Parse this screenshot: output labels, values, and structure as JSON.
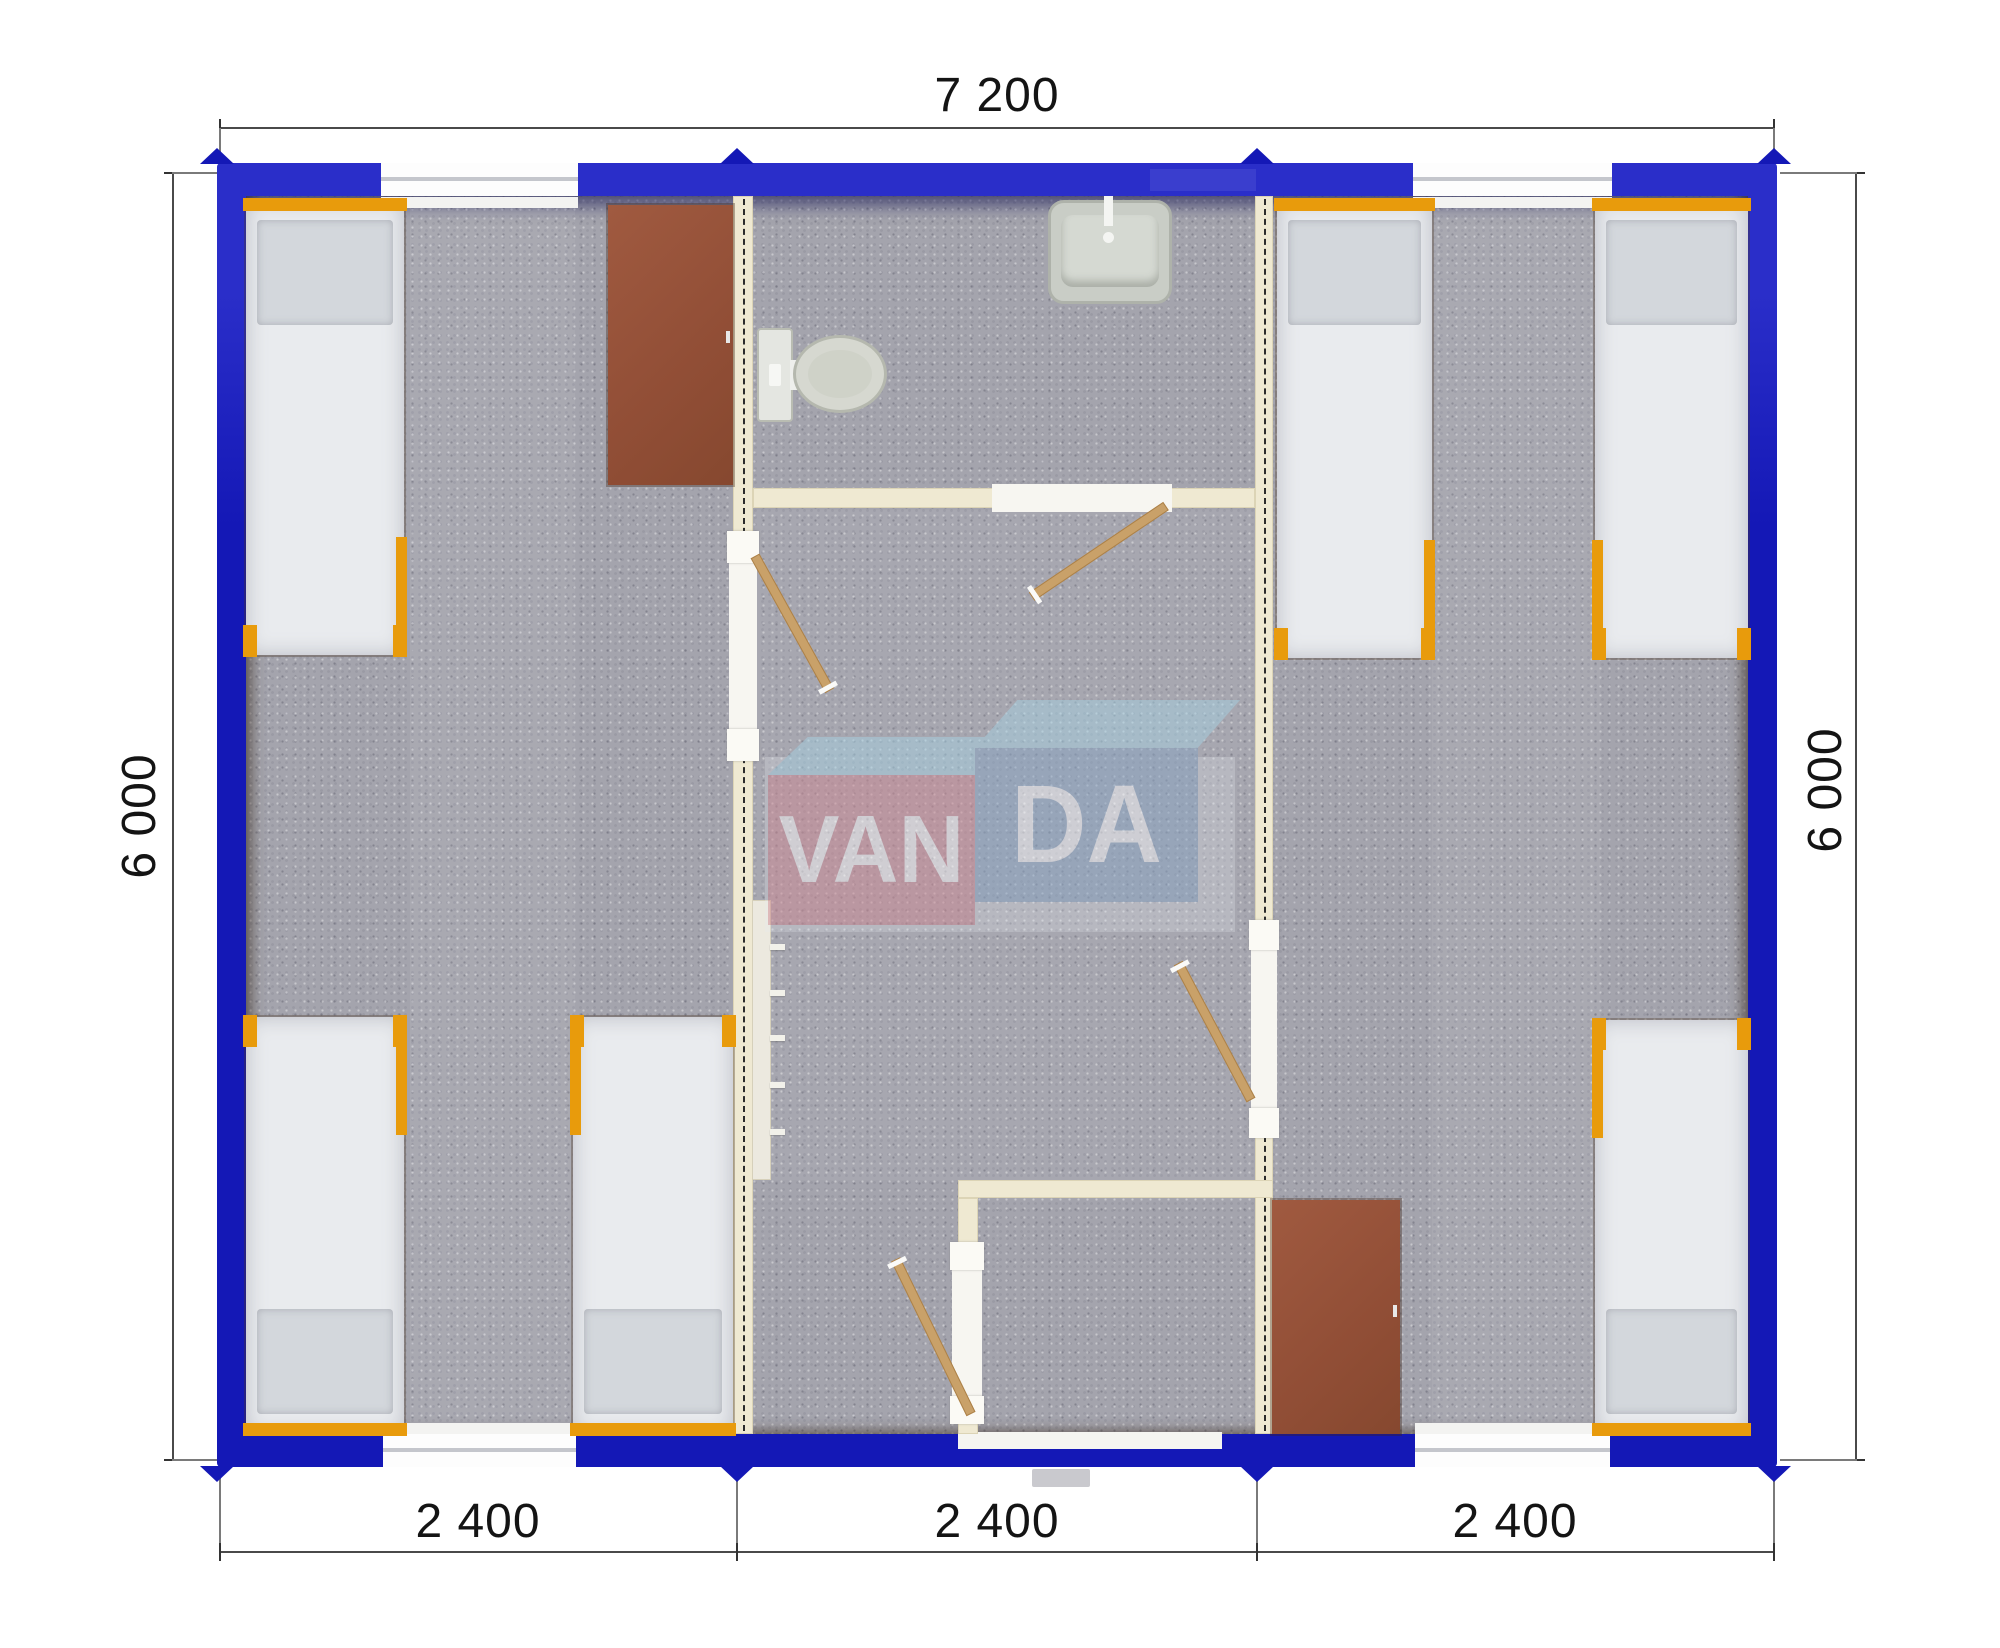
{
  "drawing": {
    "kind": "modular-building-floor-plan",
    "dimensions": {
      "width_total": "7 200",
      "height_left": "6 000",
      "height_right": "6 000",
      "bottom_segments": [
        "2 400",
        "2 400",
        "2 400"
      ]
    },
    "watermark": {
      "part1": "VAN",
      "part2": "DA"
    },
    "colors": {
      "wall_blue": "#1418b6",
      "floor_carpet_gray": "#a4a4ad",
      "partition_cream": "#efe9d2",
      "bed_frame_orange": "#e89b0c",
      "mattress_white": "#e9ebee",
      "wardrobe_brown": "#914e36",
      "door_leaf_wood": "#c9a169",
      "logo_pink": "#cf8691",
      "logo_blue": "#87a4c4",
      "logo_sky": "#a5d2e4",
      "dimension_line": "#4a4a4a"
    },
    "inventory": {
      "beds": 6,
      "wardrobes": 2,
      "toilets": 1,
      "washbasins": 1,
      "interior_doors": 4,
      "windows": 4,
      "entrance_doors": 1
    }
  }
}
